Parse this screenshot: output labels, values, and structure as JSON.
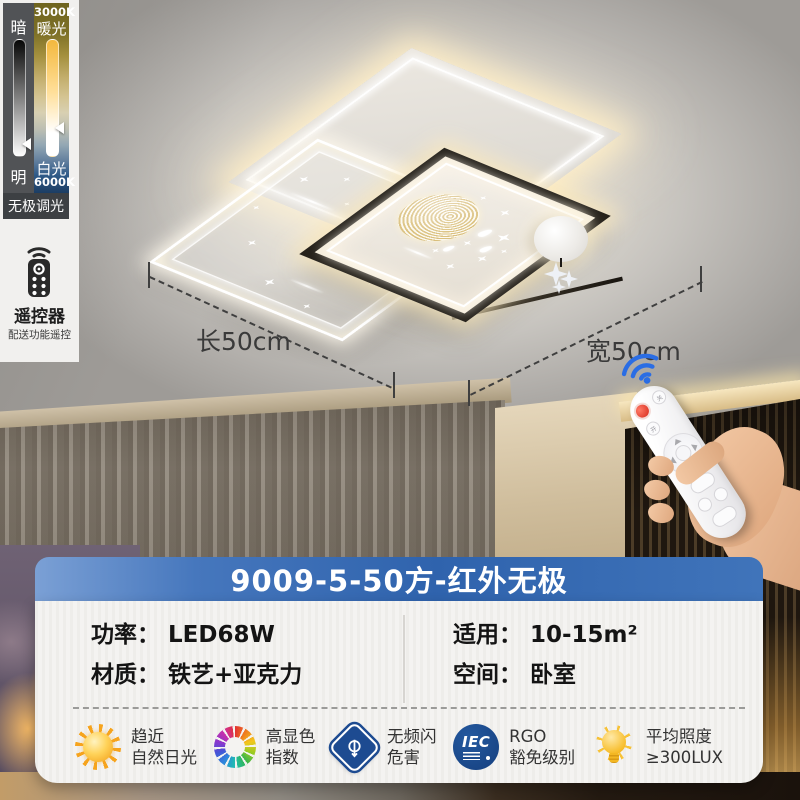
{
  "dimmer_panel": {
    "dark_label": "暗",
    "bright_label": "明",
    "warm_temp": "3000K",
    "warm_label": "暖光",
    "cool_label": "白光",
    "cool_temp": "6000K",
    "mode_label": "无极调光"
  },
  "remote_card": {
    "title": "遥控器",
    "subtitle": "配送功能遥控"
  },
  "scene": {
    "length_label": "长50cm",
    "width_label": "宽50cm",
    "remote_button_on": "开",
    "remote_button_off": "关"
  },
  "banner": {
    "model": "9009-5-50方-红外无极"
  },
  "specs": {
    "power_label": "功率：",
    "power_value": "LED68W",
    "material_label": "材质：",
    "material_value": "铁艺+亚克力",
    "area_label": "适用：",
    "area_value": "10-15m²",
    "space_label": "空间：",
    "space_value": "卧室"
  },
  "features": [
    {
      "icon": "sun-icon",
      "line1": "趋近",
      "line2": "自然日光"
    },
    {
      "icon": "color-wheel-icon",
      "line1": "高显色",
      "line2": "指数"
    },
    {
      "icon": "no-flicker-certification-icon",
      "line1": "无频闪",
      "line2": "危害"
    },
    {
      "icon": "iec-logo-icon",
      "iec_text": "IEC",
      "line1": "RGO",
      "line2": "豁免级别"
    },
    {
      "icon": "bulb-icon",
      "line1": "平均照度",
      "line2": "≥300LUX"
    }
  ],
  "colors": {
    "banner_blue": "#2f63ad",
    "wifi_blue": "#2a6de4",
    "certification_blue": "#1d4b91",
    "bulb_yellow": "#f5b81f",
    "warm_glow": "#ffeec6"
  }
}
